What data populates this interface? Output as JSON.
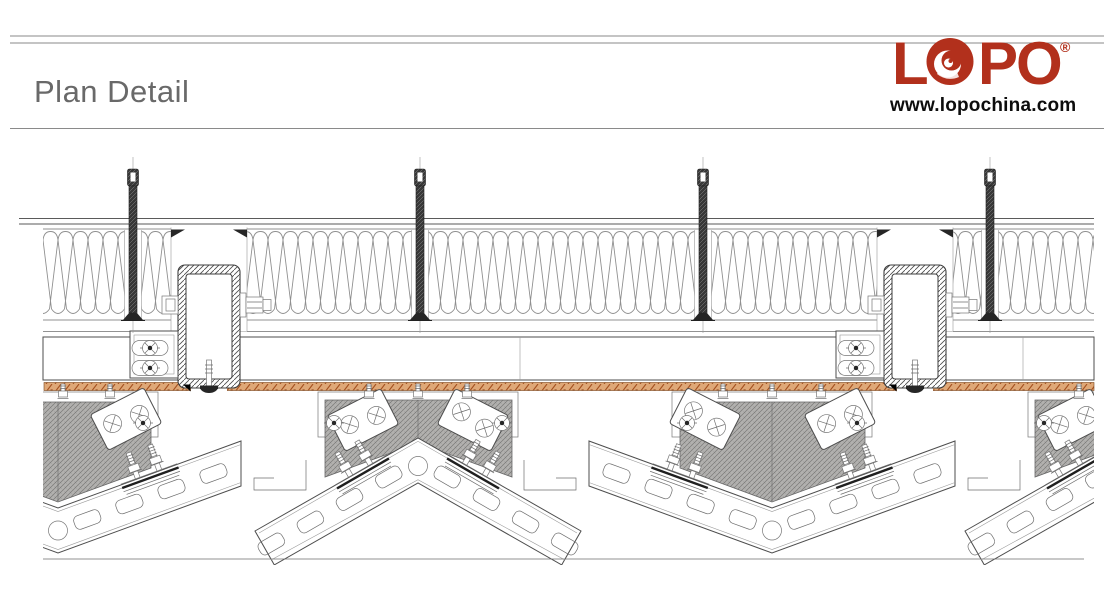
{
  "header": {
    "title": "Plan Detail"
  },
  "logo": {
    "letter_1": "L",
    "letter_3": "P",
    "letter_4": "O",
    "registered": "®",
    "website": "www.lopochina.com",
    "swirl_icon": "wave-swirl-in-letter-o"
  },
  "colors": {
    "brand_red": "#b2301c",
    "title_gray": "#696969",
    "rule_gray": "#8a8a8a",
    "ink": "#4d4d4d",
    "panel_gray": "#b2b1af",
    "membrane_tan": "#dfa877",
    "membrane_hatch": "#a4501f",
    "insulation_line": "#8f8f8f",
    "website_black": "#0d0d0d"
  }
}
